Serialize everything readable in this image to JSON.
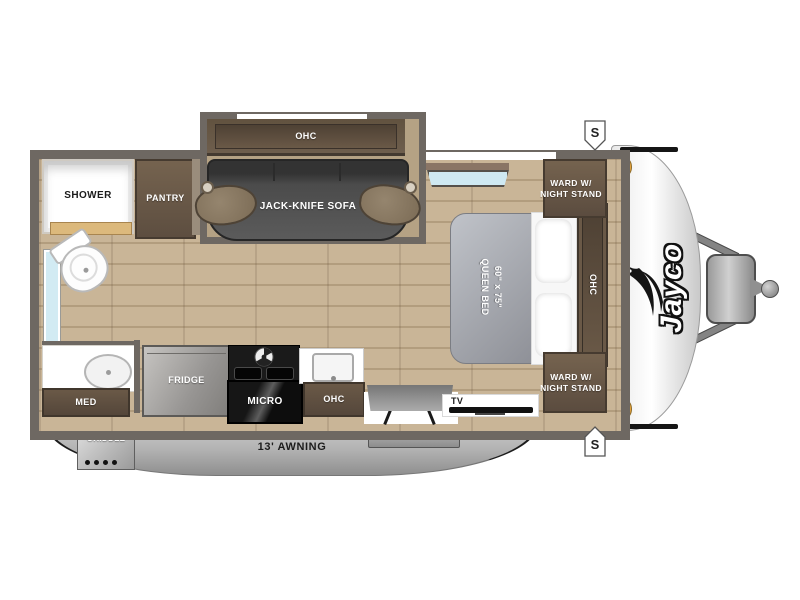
{
  "brand": "Jayco",
  "labels": {
    "slide_ohc": "OHC",
    "sofa": "JACK-KNIFE SOFA",
    "shower": "SHOWER",
    "pantry": "PANTRY",
    "med": "MED",
    "fridge": "FRIDGE",
    "micro": "MICRO",
    "kitchen_ohc": "OHC",
    "griddle": "GRIDDLE",
    "awning": "13' AWNING",
    "tv": "TV",
    "ward_top": "WARD W/\nNIGHT STAND",
    "ward_bottom": "WARD W/\nNIGHT STAND",
    "front_ohc": "OHC",
    "bed_size": "60\" x 75\"",
    "bed_type": "QUEEN BED",
    "speaker_top": "S",
    "speaker_bottom": "S"
  },
  "colors": {
    "wall": "#6e6862",
    "cabinet": "#6a5947",
    "floor": "#c2ae90",
    "awning": "#a8a8a8",
    "window_glass": "#cfe9f2",
    "clearance_light": "#e8a33c",
    "logo_outline": "#111111"
  }
}
